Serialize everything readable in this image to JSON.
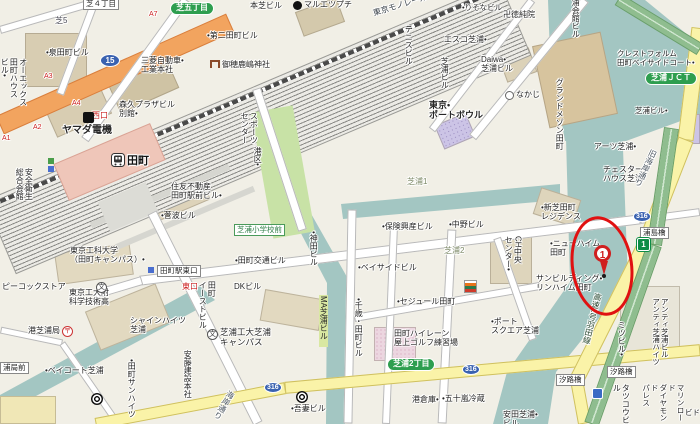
{
  "map_title": "田町・芝浦周辺地図",
  "station": {
    "name": "田町"
  },
  "marker": {
    "number": "1"
  },
  "colors": {
    "water": "#a3c6c2",
    "land": "#f1efe6",
    "route15_road": "#f2a45f",
    "major_road_yellow": "#faf3a8",
    "expressway_green": "#8fbd8f",
    "station_building": "#efc6b9",
    "badge_green": "#2e9e4f",
    "shield_blue": "#3a62b0",
    "marker_red": "#cf1f1f",
    "park_green": "#c8e2a6"
  },
  "labels": [
    {
      "n": "area-shiba5",
      "t": "芝5",
      "x": 55,
      "y": 16,
      "c": "#4a4a55"
    },
    {
      "n": "bldg-izumi-tamachi",
      "t": "•泉田町ビル",
      "x": 46,
      "y": 48
    },
    {
      "n": "bldg-mitsubishi-motors-hq",
      "t": "三菱自動車•\n工業本社",
      "x": 141,
      "y": 56
    },
    {
      "n": "bldg-morikyu-plaza",
      "t": "森久プラザビル\n別館•",
      "x": 119,
      "y": 100
    },
    {
      "n": "poi-yamada-denki",
      "t": "ヤマダ電機",
      "x": 62,
      "y": 125,
      "fz": 10,
      "b": 1
    },
    {
      "n": "bldg-honshiba",
      "t": "本芝ビル",
      "x": 250,
      "y": 1
    },
    {
      "n": "poi-maruetsu-petit",
      "t": "マルエツプチ",
      "x": 304,
      "y": 0
    },
    {
      "n": "bldg-daini-tamachi",
      "t": "•第二田町ビル",
      "x": 207,
      "y": 31
    },
    {
      "n": "poi-miho-kashima-shrine",
      "t": "御穂鹿嶋神社",
      "x": 222,
      "y": 60
    },
    {
      "n": "rail-tokyo-monorail",
      "t": "東京モノレール",
      "x": 372,
      "y": 9,
      "r": -17,
      "c": "#384048"
    },
    {
      "n": "bldg-ox-tamachi-house",
      "t": "オーエックス\n田町ハウス\nビル•",
      "x": 0,
      "y": 58,
      "v": 1,
      "h": 92
    },
    {
      "n": "bldg-anzen-eisei-kaikan",
      "t": "安全衛生\n総合会館",
      "x": 15,
      "y": 168,
      "v": 1,
      "h": 48
    },
    {
      "n": "bldg-sumitomo-tamachi-ekimae",
      "t": "住友不動産\n田町駅前ビル•",
      "x": 171,
      "y": 182
    },
    {
      "n": "bldg-suganami",
      "t": "•菅波ビル",
      "x": 161,
      "y": 211
    },
    {
      "n": "poi-tokyo-univ-tech-campus",
      "t": "東京工科大学\n（田町キャンパス）•",
      "x": 70,
      "y": 246
    },
    {
      "n": "sign-tamachi-east-exit",
      "t": "田町駅東口",
      "x": 157,
      "y": 265,
      "cls": "box"
    },
    {
      "n": "exit-east",
      "t": "東口",
      "x": 182,
      "y": 282,
      "c": "#cc2222"
    },
    {
      "n": "exit-west",
      "t": "西口",
      "x": 92,
      "y": 111,
      "c": "#cc2222"
    },
    {
      "n": "exit-a7",
      "t": "A7",
      "x": 149,
      "y": 11,
      "c": "#cc2222",
      "fz": 7
    },
    {
      "n": "exit-a3",
      "t": "A3",
      "x": 44,
      "y": 73,
      "c": "#cc2222",
      "fz": 7
    },
    {
      "n": "exit-a4",
      "t": "A4",
      "x": 72,
      "y": 100,
      "c": "#cc2222",
      "fz": 7
    },
    {
      "n": "exit-a2",
      "t": "A2",
      "x": 33,
      "y": 124,
      "c": "#cc2222",
      "fz": 7
    },
    {
      "n": "exit-a1",
      "t": "A1",
      "x": 2,
      "y": 135,
      "c": "#cc2222",
      "fz": 7
    },
    {
      "n": "badge-shiba-5chome",
      "t": "芝五丁目",
      "x": 170,
      "y": 2,
      "cls": "badge"
    },
    {
      "n": "shield-route-15",
      "t": "15",
      "x": 100,
      "y": 54,
      "cls": "shield"
    },
    {
      "n": "poi-minato-sports-center",
      "t": "スポーツ\nセンター",
      "x": 240,
      "y": 112,
      "v": 1,
      "h": 66
    },
    {
      "n": "poi-minato-ku",
      "t": "港区•",
      "x": 253,
      "y": 147,
      "v": 1,
      "h": 26
    },
    {
      "n": "area-shibaura-1",
      "t": "芝浦1",
      "x": 407,
      "y": 177,
      "c": "#7d8a68"
    },
    {
      "n": "busstop-shibaura-elementary",
      "t": "芝浦小学校前",
      "x": 234,
      "y": 224,
      "cls": "busstop"
    },
    {
      "n": "bldg-tamachi-kotsu",
      "t": "•田町交通ビル",
      "x": 235,
      "y": 256
    },
    {
      "n": "bldg-kanda",
      "t": "•神田ビル",
      "x": 309,
      "y": 231,
      "v": 1,
      "h": 42
    },
    {
      "n": "bldg-hoken-kosan",
      "t": "•保険興産ビル",
      "x": 382,
      "y": 222
    },
    {
      "n": "bldg-nakano",
      "t": "•中野ビル",
      "x": 449,
      "y": 220
    },
    {
      "n": "bldg-bayside",
      "t": "•ベイサイドビル",
      "x": 358,
      "y": 263
    },
    {
      "n": "area-shibaura-2",
      "t": "芝浦2",
      "x": 444,
      "y": 246,
      "c": "#7d8a68"
    },
    {
      "n": "bldg-daiwa-shibaura",
      "t": "Daiwa•\n芝浦ビル",
      "x": 481,
      "y": 55
    },
    {
      "n": "bldg-risona",
      "t": "•りそなビル",
      "x": 462,
      "y": 4,
      "fz": 7.5
    },
    {
      "n": "poi-tokujunin-temple",
      "t": "卍徳純院",
      "x": 503,
      "y": 10
    },
    {
      "n": "bldg-esco-shibaura",
      "t": "エスコ芝浦•",
      "x": 444,
      "y": 35
    },
    {
      "n": "poi-nakaji",
      "t": "なかじ",
      "x": 516,
      "y": 90
    },
    {
      "n": "bldg-tennis",
      "t": "テニスビル",
      "x": 404,
      "y": 25,
      "v": 1,
      "h": 44
    },
    {
      "n": "poi-tokyo-port-bowl",
      "t": "東京•\nポートボウル",
      "x": 429,
      "y": 100,
      "fz": 9,
      "b": 1
    },
    {
      "n": "bldg-shibaura-v",
      "t": "芝浦ビル",
      "x": 440,
      "y": 57,
      "v": 1,
      "h": 38
    },
    {
      "n": "bldg-shibaura-kaikan",
      "t": "芝浦会館ビル",
      "x": 571,
      "y": -10,
      "v": 1,
      "h": 52
    },
    {
      "n": "bldg-crestform-bayside",
      "t": "クレストフォルム\n田町ベイサイドコート•",
      "x": 617,
      "y": 50,
      "fz": 7.5
    },
    {
      "n": "badge-shibaura-jct",
      "t": "芝浦ＪＣＴ",
      "x": 645,
      "y": 72,
      "cls": "badge"
    },
    {
      "n": "bldg-shibaura",
      "t": "芝浦ビル•",
      "x": 635,
      "y": 107,
      "fz": 7.5
    },
    {
      "n": "bldg-grand-maison-tamachi",
      "t": "グランドメゾン田町",
      "x": 555,
      "y": 78,
      "v": 1,
      "h": 82
    },
    {
      "n": "bldg-shinshiba-residence",
      "t": "•新芝田町\nレジデンス",
      "x": 541,
      "y": 203
    },
    {
      "n": "bldg-new-heim-tamachi",
      "t": "•ニューハイム\n田町",
      "x": 550,
      "y": 239
    },
    {
      "n": "bldg-arts-shibaura",
      "t": "アーツ芝浦•",
      "x": 594,
      "y": 142
    },
    {
      "n": "bldg-chester-house",
      "t": "チェスター•\nハウス芝浦",
      "x": 603,
      "y": 165
    },
    {
      "n": "road-kyu-kaigan-dori",
      "t": "旧海岸通り",
      "x": 650,
      "y": 148,
      "v": 1,
      "h": 80,
      "r": 25,
      "c": "#4a5560"
    },
    {
      "n": "bridge-urashima",
      "t": "浦島橋",
      "x": 640,
      "y": 227,
      "cls": "box"
    },
    {
      "n": "shield-route-316-ne",
      "t": "316",
      "x": 633,
      "y": 211,
      "cls": "shield s"
    },
    {
      "n": "bldg-sun-building-rinheim",
      "t": "サンビルディング•\nリンハイム田町",
      "x": 536,
      "y": 274
    },
    {
      "n": "road-expressway-haneda",
      "t": "高速1号羽田線",
      "x": 594,
      "y": 292,
      "v": 1,
      "h": 76,
      "r": 14,
      "c": "#2c4a32"
    },
    {
      "n": "shield-expressway-1",
      "t": "1",
      "x": 637,
      "y": 238,
      "cls": "exp"
    },
    {
      "n": "bridge-shioji-1",
      "t": "汐路橋",
      "x": 556,
      "y": 374,
      "cls": "box"
    },
    {
      "n": "bridge-shioji-2",
      "t": "汐路橋",
      "x": 607,
      "y": 366,
      "cls": "box"
    },
    {
      "n": "bldg-port-square-shibaura",
      "t": "•ポート\nスクエア芝浦",
      "x": 491,
      "y": 317
    },
    {
      "n": "bldg-anti-shibaura",
      "t": "アンティ芝浦ビル\nアンティ芝浦ハイツ",
      "x": 651,
      "y": 298,
      "v": 1,
      "h": 74,
      "fz": 7.5
    },
    {
      "n": "bldg-mitsu",
      "t": "ミツビル•",
      "x": 617,
      "y": 321,
      "v": 1,
      "h": 40
    },
    {
      "n": "bldg-tatsuko",
      "t": "タツコウビル",
      "x": 612,
      "y": 384,
      "v": 1,
      "h": 40
    },
    {
      "n": "bldg-marine-road-diamond-palace",
      "t": "マリンロード\nダイヤモンド\nパレス",
      "x": 641,
      "y": 384,
      "v": 1,
      "h": 40,
      "fz": 7.5
    },
    {
      "n": "bldg-yasuda-shibaura",
      "t": "安田芝浦•\nビル",
      "x": 503,
      "y": 410
    },
    {
      "n": "bldg-igarashi-reizo",
      "t": "•五十嵐冷蔵",
      "x": 442,
      "y": 394
    },
    {
      "n": "bldg-minato-soko",
      "t": "港倉庫•",
      "x": 412,
      "y": 395
    },
    {
      "n": "bldg-azuma",
      "t": "•吾妻ビル",
      "x": 291,
      "y": 404
    },
    {
      "n": "bldg-dk",
      "t": "DKビル",
      "x": 234,
      "y": 282
    },
    {
      "n": "bldg-ma-shibaura",
      "t": "MA芝浦ビル",
      "x": 319,
      "y": 295,
      "v": 1,
      "h": 52,
      "cls": "hl"
    },
    {
      "n": "bldg-chitose-tamachi",
      "t": "•千歳・田町ビル",
      "x": 354,
      "y": 298,
      "v": 1,
      "h": 66
    },
    {
      "n": "bldg-sejour-tamachi",
      "t": "•セジュール田町",
      "x": 397,
      "y": 297
    },
    {
      "n": "poi-tamachi-hi-lane",
      "t": "田町ハイレーン\n屋上ゴルフ練習場",
      "x": 394,
      "y": 329
    },
    {
      "n": "badge-shibaura-2chome",
      "t": "芝浦2丁目",
      "x": 387,
      "y": 358,
      "cls": "badge"
    },
    {
      "n": "shield-route-316-sw",
      "t": "316",
      "x": 264,
      "y": 382,
      "cls": "shield s"
    },
    {
      "n": "shield-route-316-mid",
      "t": "316",
      "x": 462,
      "y": 364,
      "cls": "shield s"
    },
    {
      "n": "road-kaigan-dori",
      "t": "海岸通り",
      "x": 228,
      "y": 389,
      "v": 1,
      "h": 36,
      "r": 30,
      "c": "#4a5560"
    },
    {
      "n": "poi-shibaura-tech-campus",
      "t": "芝浦工大芝浦\nキャンパス",
      "x": 220,
      "y": 328,
      "fz": 8.5
    },
    {
      "n": "poi-tokyo-tech-hs",
      "t": "東京工大附\n科学技術高",
      "x": 69,
      "y": 288
    },
    {
      "n": "poi-peacock-store",
      "t": "ピーコックストア",
      "x": 2,
      "y": 282
    },
    {
      "n": "poi-post-office-shibaura",
      "t": "港芝浦局",
      "x": 28,
      "y": 326
    },
    {
      "n": "bldg-baycourt-shibaura",
      "t": "•ベイコート芝浦",
      "x": 45,
      "y": 366
    },
    {
      "n": "busstop-ura-mae",
      "t": "浦局前",
      "x": 0,
      "y": 362,
      "cls": "box"
    },
    {
      "n": "bldg-shine-heights-shibaura",
      "t": "シャインハイツ\n芝浦",
      "x": 130,
      "y": 316
    },
    {
      "n": "bldg-tamachi-sun-heights",
      "t": "•田町サンハイツ",
      "x": 127,
      "y": 359,
      "v": 1,
      "h": 60
    },
    {
      "n": "bldg-ando-honsha",
      "t": "安藤建設本社",
      "x": 183,
      "y": 350,
      "v": 1,
      "h": 52
    },
    {
      "n": "bldg-tamachi-east",
      "t": "田町\nイーストビル",
      "x": 198,
      "y": 281,
      "v": 1,
      "h": 54
    },
    {
      "n": "bldg-ch-chuo-center",
      "t": "CH中央\nセンター•",
      "x": 504,
      "y": 236,
      "v": 1,
      "h": 52
    },
    {
      "n": "sign-shiba-4chome",
      "t": "芝４丁目",
      "x": 83,
      "y": -2,
      "cls": "box"
    },
    {
      "n": "bldg-bido-partial",
      "t": "ビド",
      "x": 685,
      "y": 409,
      "fz": 7.5
    }
  ],
  "icons": [
    {
      "n": "maruetsu-icon",
      "k": "dot",
      "x": 293,
      "y": 1
    },
    {
      "n": "torii-icon",
      "k": "torii",
      "x": 210,
      "y": 60
    },
    {
      "n": "yamada-store-icon",
      "k": "sq",
      "x": 83,
      "y": 112
    },
    {
      "n": "school-icon-hs",
      "k": "school",
      "g": "文",
      "x": 96,
      "y": 282
    },
    {
      "n": "school-icon-sit",
      "k": "school",
      "g": "文",
      "x": 207,
      "y": 329
    },
    {
      "n": "seven-eleven-icon",
      "k": "seven",
      "x": 464,
      "y": 280
    },
    {
      "n": "police-icon",
      "k": "police",
      "x": 592,
      "y": 388
    },
    {
      "n": "nakaji-icon",
      "k": "circ",
      "x": 505,
      "y": 91
    },
    {
      "n": "post-office-icon",
      "k": "post",
      "g": "〒",
      "x": 62,
      "y": 326
    },
    {
      "n": "subway-icon-1",
      "k": "subway",
      "x": 91,
      "y": 393
    },
    {
      "n": "subway-icon-2",
      "k": "subway",
      "x": 296,
      "y": 391
    },
    {
      "n": "poi-icon-green",
      "k": "minig",
      "x": 48,
      "y": 158
    },
    {
      "n": "poi-icon-blue",
      "k": "minib",
      "x": 48,
      "y": 166
    },
    {
      "n": "bus-sign-icon",
      "k": "minib",
      "x": 148,
      "y": 267
    }
  ]
}
